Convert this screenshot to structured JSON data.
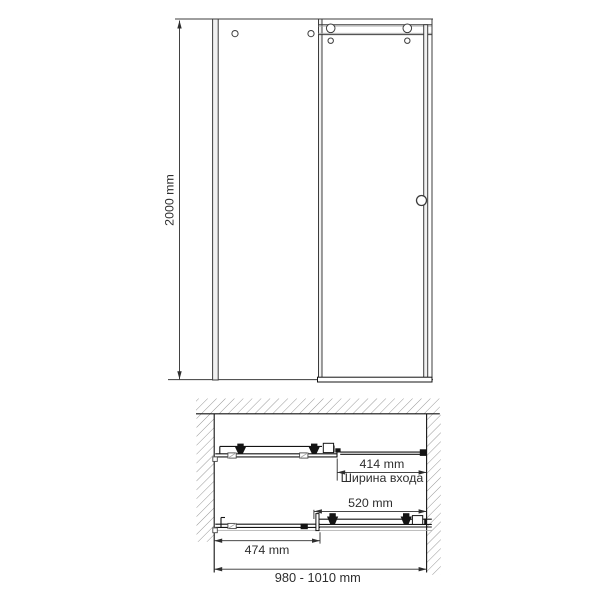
{
  "front_view": {
    "height_label": "2000 mm"
  },
  "plan_view": {
    "entrance_width_label": "414 mm",
    "entrance_width_caption": "Ширина входа",
    "door_width_label": "520 mm",
    "fixed_panel_width_label": "474 mm",
    "overall_width_label": "980 - 1010 mm"
  },
  "colors": {
    "bg": "#ffffff",
    "line": "#3c3c3c",
    "line-dark": "#141414",
    "hatch": "#8e8e8e",
    "dim": "#2e2e2e"
  }
}
